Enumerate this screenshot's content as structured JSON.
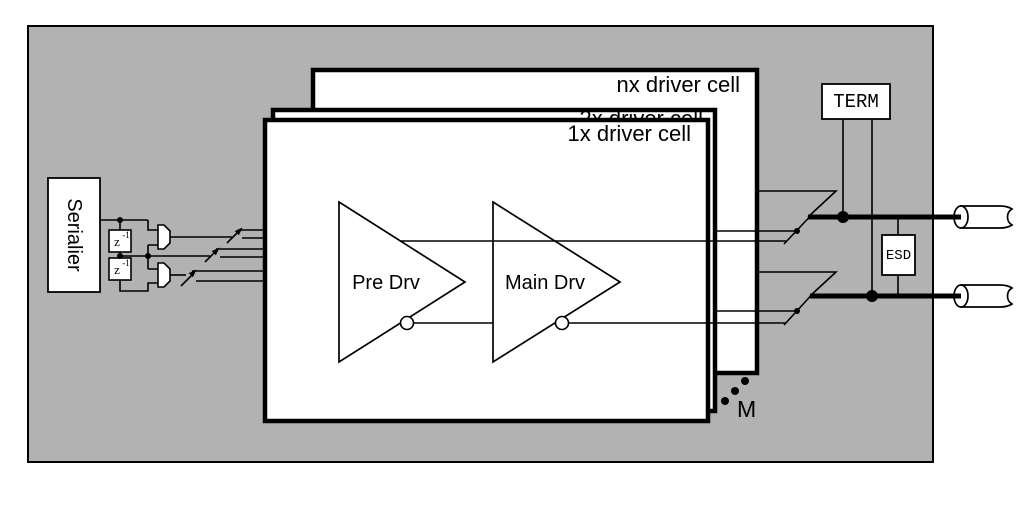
{
  "diagram": {
    "serializer_label": "Serialier",
    "delay1": {
      "base": "z",
      "exp": "-1"
    },
    "delay2": {
      "base": "z",
      "exp": "-1"
    },
    "cells": {
      "nx": "nx driver cell",
      "x2": "2x driver cell",
      "x1": "1x driver cell"
    },
    "pre_driver_label": "Pre Drv",
    "main_driver_label": "Main Drv",
    "term_label": "TERM",
    "esd_label": "ESD",
    "multiplicity_label": "M",
    "colors": {
      "background": "#b2b2b2",
      "line": "#000000",
      "box_fill": "#ffffff"
    }
  }
}
